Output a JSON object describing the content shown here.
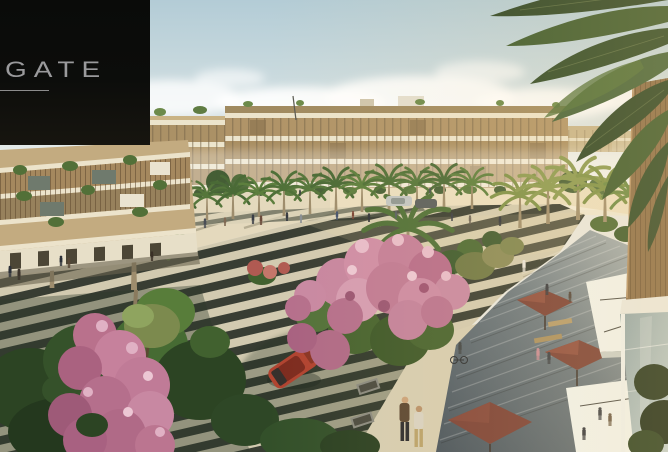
{
  "logo": {
    "brand": "GATE"
  },
  "scene": {
    "type": "architectural-rendering",
    "subject": "landscaped palm boulevard with striped paving, mixed-use beige buildings, pink flowering trees, stepped cafe terrace with maroon parasols and white awnings, red car, pedestrians"
  },
  "palette": {
    "sky_top": "#b3ccd6",
    "sky_horizon": "#f3f2ed",
    "building_beige": "#b49a6d",
    "building_band": "#ece4cc",
    "palm_green": "#4f7038",
    "stripe_dark": "#383d33",
    "stripe_light": "#d2cab0",
    "flower_pink": "#c786a0",
    "terrace_shadow": "#46525c",
    "parasol_maroon": "#7a4036",
    "awning_white": "#f0f4f0",
    "car_red": "#b04330",
    "wood_facade": "#8a6d48",
    "logo_bg": "#0c0d0b",
    "logo_text": "#9a9a9c"
  }
}
